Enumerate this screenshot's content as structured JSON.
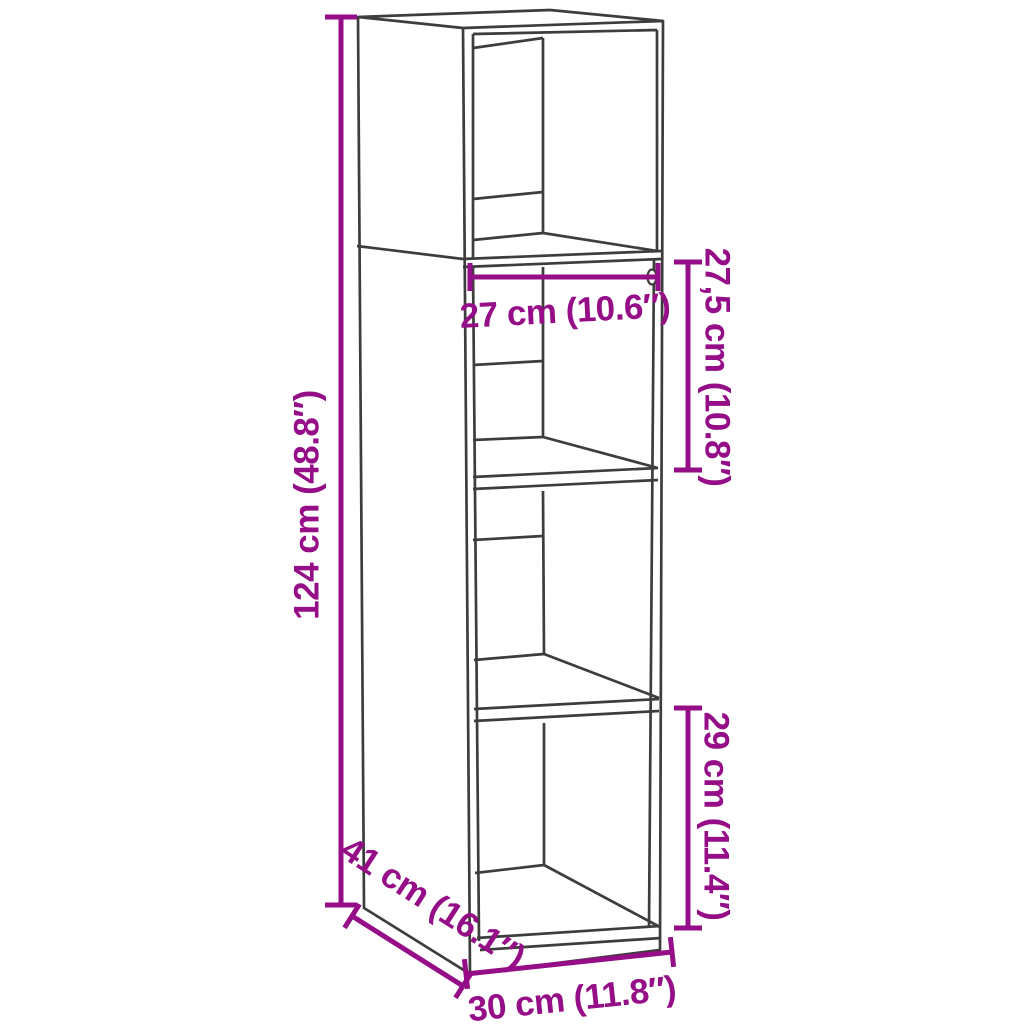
{
  "diagram": {
    "subject": "tall-cabinet-with-open-shelves-dimension-drawing",
    "colors": {
      "outline": "#3d3d3b",
      "dimension": "#950d87",
      "background": "#ffffff"
    },
    "dimensions": {
      "height": {
        "label": "124 cm (48.8″)",
        "cm": "124",
        "inches": "48.8"
      },
      "opening_width": {
        "label": "27 cm (10.6″)",
        "cm": "27",
        "inches": "10.6"
      },
      "upper_compartment": {
        "label": "27,5 cm (10.8″)",
        "cm": "27,5",
        "inches": "10.8"
      },
      "lower_compartment": {
        "label": "29 cm (11.4″)",
        "cm": "29",
        "inches": "11.4"
      },
      "depth": {
        "label": "41 cm (16.1″)",
        "cm": "41",
        "inches": "16.1"
      },
      "width": {
        "label": "30 cm (11.8″)",
        "cm": "30",
        "inches": "11.8"
      }
    }
  }
}
